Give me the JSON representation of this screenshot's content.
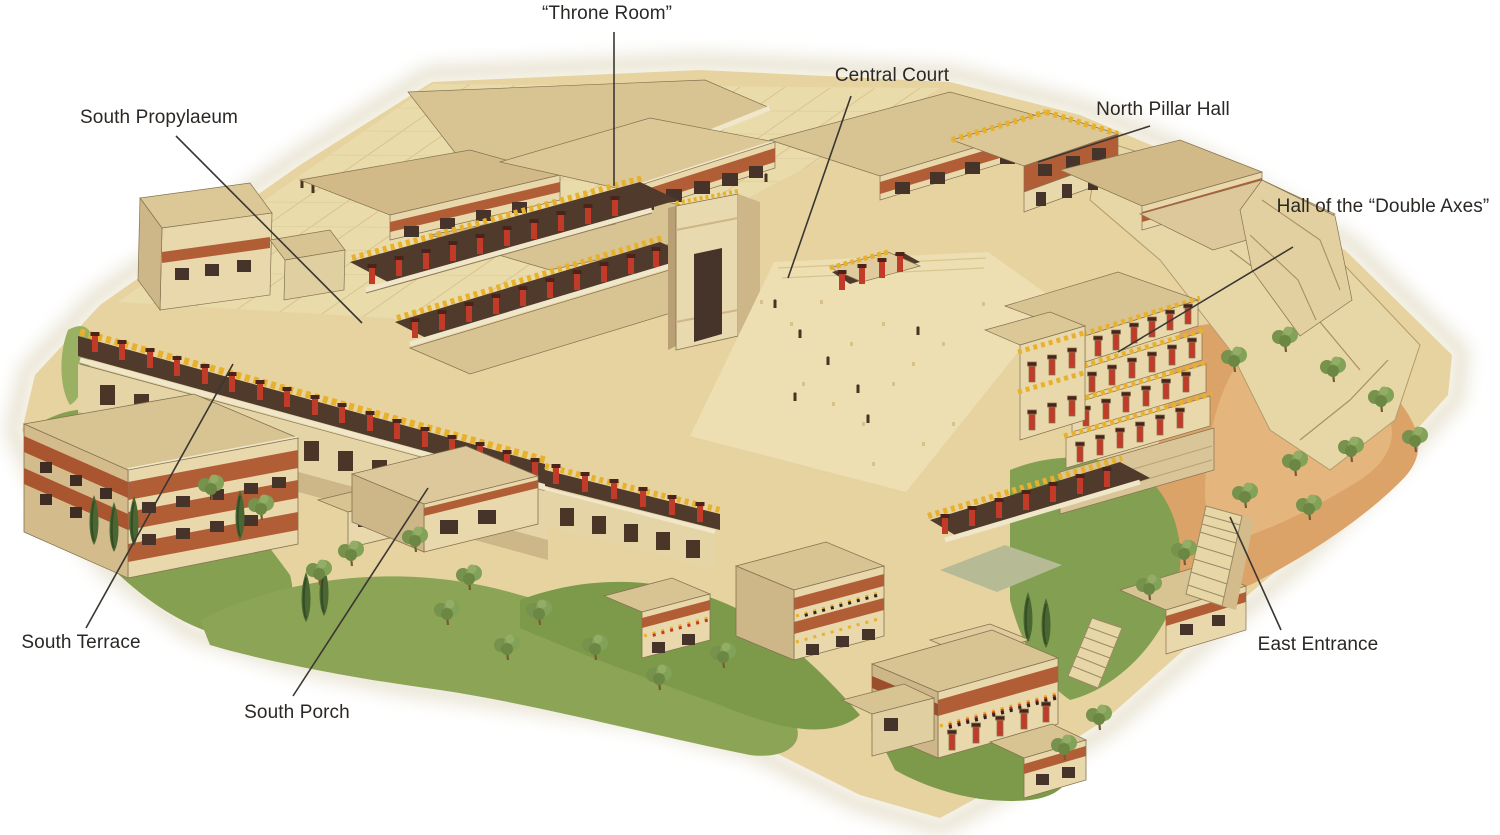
{
  "palette": {
    "roof_tan": "#d8c393",
    "wall_cream": "#e8d8ab",
    "brick_red": "#b15e37",
    "column_red": "#c23b28",
    "column_capital": "#4a241a",
    "horns_gold": "#e8b12c",
    "court_paving": "#eddfb2",
    "grass_green": "#8ba456",
    "soil_orange": "#dca368",
    "opening_dark": "#46332a",
    "label_text": "#2b2724",
    "leader_line": "#3a3632"
  },
  "labels": [
    {
      "id": "throne-room",
      "text": "“Throne Room”"
    },
    {
      "id": "central-court",
      "text": "Central Court"
    },
    {
      "id": "north-pillar-hall",
      "text": "North Pillar Hall"
    },
    {
      "id": "hall-of-the-double-axes",
      "text": "Hall of the “Double Axes”"
    },
    {
      "id": "south-propylaeum",
      "text": "South Propylaeum"
    },
    {
      "id": "south-terrace",
      "text": "South Terrace"
    },
    {
      "id": "south-porch",
      "text": "South Porch"
    },
    {
      "id": "east-entrance",
      "text": "East Entrance"
    }
  ]
}
